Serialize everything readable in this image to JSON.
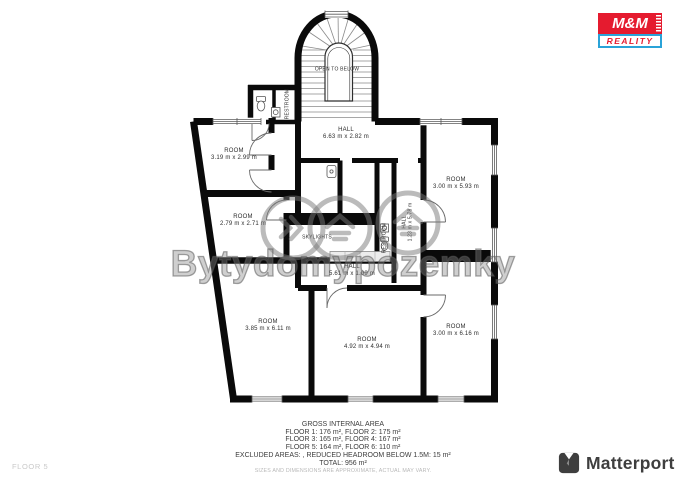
{
  "branding": {
    "mm_reality": {
      "line1": "M&M",
      "line2": "REALITY",
      "red": "#e51b2f",
      "blue": "#2aa3d8"
    },
    "matterport": {
      "label": "Matterport",
      "color": "#3e3e3e"
    }
  },
  "floor_tag": "FLOOR 5",
  "watermark": {
    "text": "Bytydomypozemky"
  },
  "plan": {
    "labels": [
      {
        "title": "OPEN TO BELOW",
        "dims": ""
      },
      {
        "title": "RESTROOM",
        "dims": ""
      },
      {
        "title": "HALL",
        "dims": "6.63 m x 2.82 m"
      },
      {
        "title": "ROOM",
        "dims": "3.19 m x 2.99 m"
      },
      {
        "title": "ROOM",
        "dims": "2.79 m x 2.71 m"
      },
      {
        "title": "ROOM",
        "dims": "3.00 m x 5.93 m"
      },
      {
        "title": "SKYLIGHTS",
        "dims": ""
      },
      {
        "title": "HALL",
        "dims": "1.23 m x 5.78 m"
      },
      {
        "title": "RESTROOM",
        "dims": ""
      },
      {
        "title": "HALL",
        "dims": "5.61 m x 1.09 m"
      },
      {
        "title": "ROOM",
        "dims": "3.85 m x 6.11 m"
      },
      {
        "title": "ROOM",
        "dims": "4.92 m x 4.94 m"
      },
      {
        "title": "ROOM",
        "dims": "3.00 m x 6.16 m"
      }
    ]
  },
  "footer": {
    "title": "GROSS INTERNAL AREA",
    "lines": [
      "FLOOR 1: 176 m², FLOOR 2: 175 m²",
      "FLOOR 3: 165 m², FLOOR 4: 167 m²",
      "FLOOR 5: 164 m², FLOOR 6: 110 m²",
      "EXCLUDED AREAS: , REDUCED HEADROOM BELOW 1.5M: 15 m²",
      "TOTAL: 956 m²"
    ],
    "disclaimer": "SIZES AND DIMENSIONS ARE APPROXIMATE, ACTUAL MAY VARY."
  }
}
